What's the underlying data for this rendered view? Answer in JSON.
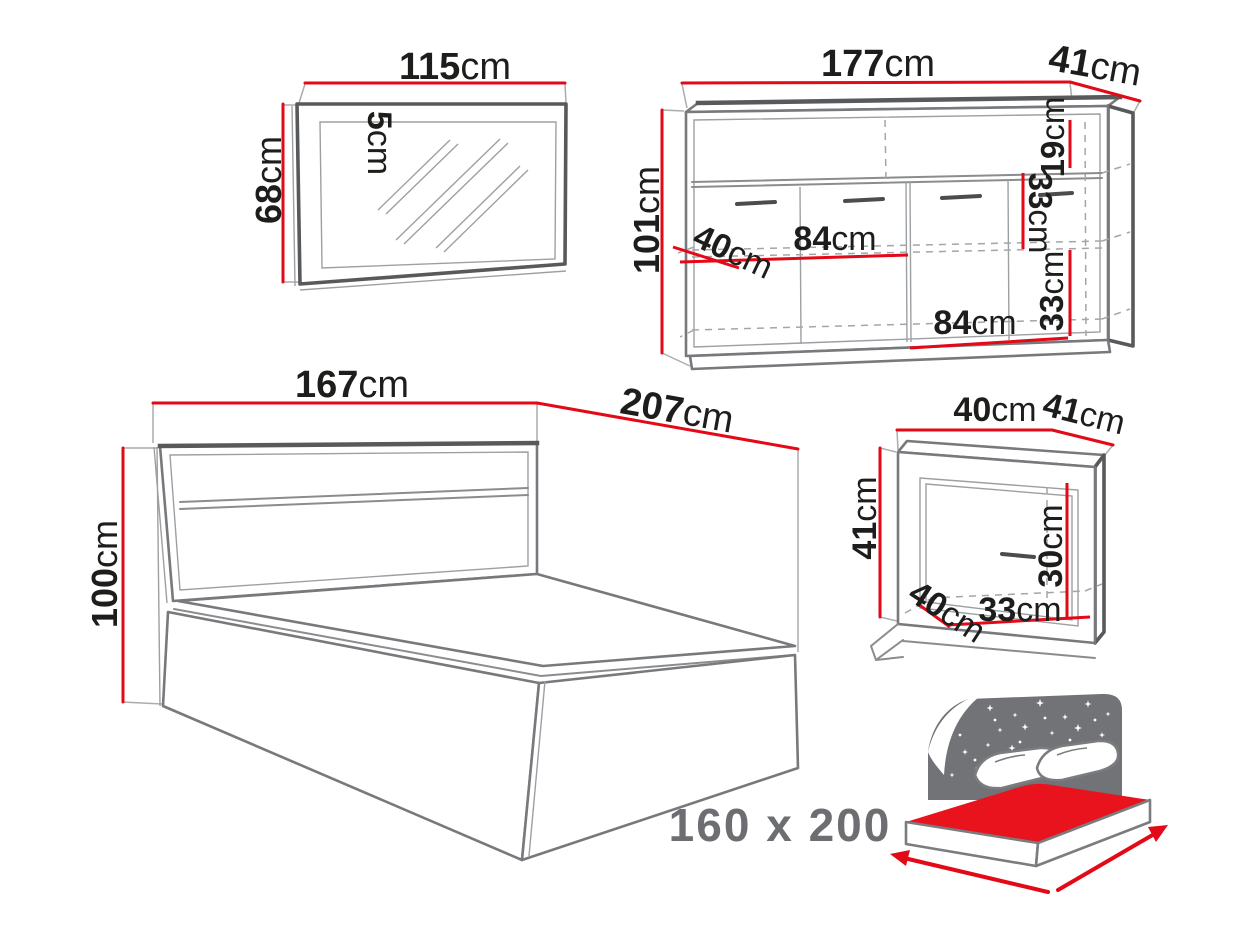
{
  "diagram_title": "bedroom-furniture-set-dimensions",
  "colors": {
    "dimension_red": "#e30917",
    "outline_gray": "#8a8c8e",
    "frame_dark_gray": "#58595b",
    "text_black": "#1d1d1b",
    "muted_gray": "#6d6e71",
    "icon_red": "#e8131d",
    "background": "#ffffff"
  },
  "mirror": {
    "width": {
      "value": "115",
      "unit": "cm"
    },
    "height": {
      "value": "68",
      "unit": "cm"
    },
    "frame_depth": {
      "value": "5",
      "unit": "cm"
    }
  },
  "dresser": {
    "width": {
      "value": "177",
      "unit": "cm"
    },
    "depth": {
      "value": "41",
      "unit": "cm"
    },
    "height": {
      "value": "101",
      "unit": "cm"
    },
    "top_shelf_height": {
      "value": "19",
      "unit": "cm"
    },
    "middle_shelf_height": {
      "value": "33",
      "unit": "cm"
    },
    "bottom_shelf_height": {
      "value": "33",
      "unit": "cm"
    },
    "half_width_middle": {
      "value": "84",
      "unit": "cm"
    },
    "half_width_bottom": {
      "value": "84",
      "unit": "cm"
    },
    "inner_depth": {
      "value": "40",
      "unit": "cm"
    }
  },
  "bed": {
    "width": {
      "value": "167",
      "unit": "cm"
    },
    "length": {
      "value": "207",
      "unit": "cm"
    },
    "height": {
      "value": "100",
      "unit": "cm"
    },
    "mattress_size_caption": "160 x 200"
  },
  "nightstand": {
    "width": {
      "value": "40",
      "unit": "cm"
    },
    "depth": {
      "value": "41",
      "unit": "cm"
    },
    "height": {
      "value": "41",
      "unit": "cm"
    },
    "inner_height": {
      "value": "30",
      "unit": "cm"
    },
    "inner_width": {
      "value": "33",
      "unit": "cm"
    },
    "inner_depth": {
      "value": "40",
      "unit": "cm"
    }
  },
  "icon": {
    "name": "storage-bed-with-starry-headboard-icon",
    "meaning": "bed with mattress surface highlighted"
  }
}
